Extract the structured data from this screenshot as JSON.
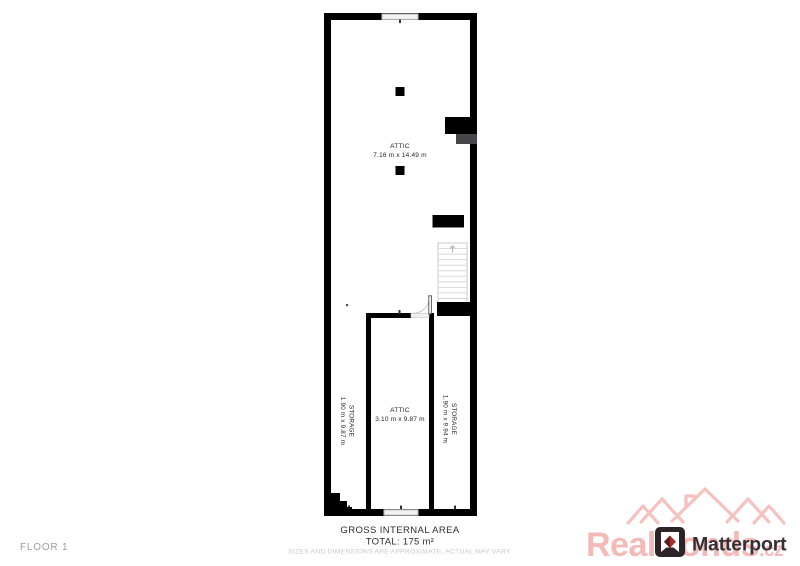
{
  "floor_plan": {
    "rooms": [
      {
        "name": "ATTIC",
        "dims": "7.16 m x 14.49 m"
      },
      {
        "name": "ATTIC",
        "dims": "3.10 m x 9.87 m"
      },
      {
        "name": "STORAGE",
        "dims": "1.90 m x 9.87 m"
      },
      {
        "name": "STORAGE",
        "dims": "1.90 m x 9.94 m"
      }
    ]
  },
  "footer": {
    "floor_label": "FLOOR 1",
    "area_title": "GROSS INTERNAL AREA",
    "area_total": "TOTAL: 175 m²",
    "disclaimer": "SIZES AND DIMENSIONS ARE APPROXIMATE, ACTUAL MAY VARY."
  },
  "branding": {
    "logo_text": "Matterport",
    "watermark_text": "RealBonds",
    "watermark_suffix": ".cz"
  },
  "colors": {
    "wall": "#000000",
    "chimney_gray": "#46464b",
    "window": "#f2f2f4",
    "stair_tread": "#d9d9dc",
    "label_text": "#1f1f1f",
    "muted_text": "#9d9d9d",
    "disclaimer_text": "#c9c9c9",
    "watermark_pink": "#f3bab8",
    "logo_dark": "#2d2428",
    "logo_red": "#a23230"
  }
}
